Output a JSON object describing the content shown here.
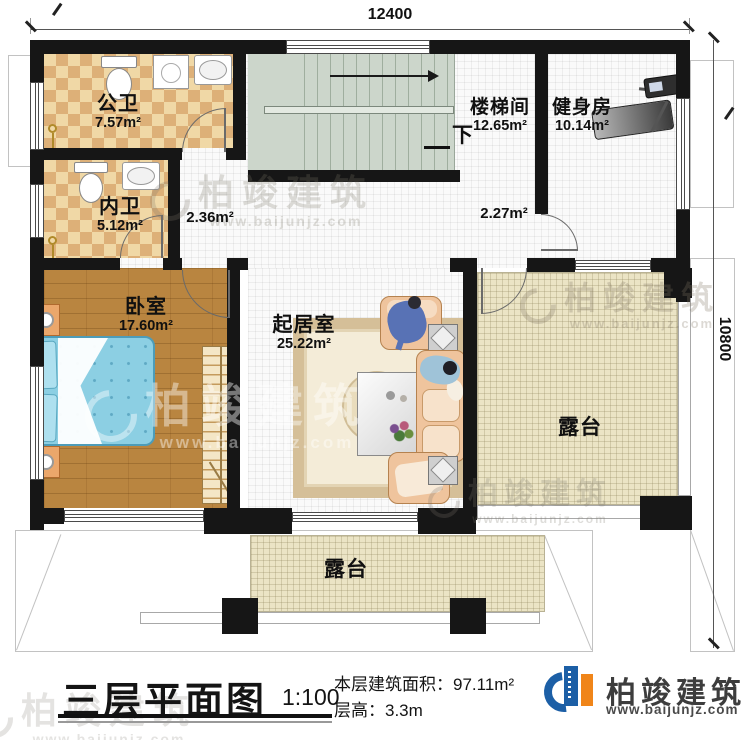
{
  "dimensions": {
    "top": "12400",
    "right": "10800"
  },
  "rooms": {
    "public_bath": {
      "name": "公卫",
      "area": "7.57m²"
    },
    "ensuite_bath": {
      "name": "内卫",
      "area": "5.12m²"
    },
    "bedroom": {
      "name": "卧室",
      "area": "17.60m²"
    },
    "stairwell": {
      "name": "楼梯间",
      "area": "12.65m²"
    },
    "gym": {
      "name": "健身房",
      "area": "10.14m²"
    },
    "living_room": {
      "name": "起居室",
      "area": "25.22m²"
    },
    "terrace_right": {
      "name": "露台"
    },
    "terrace_bottom": {
      "name": "露台"
    },
    "hall_left": {
      "area": "2.36m²"
    },
    "hall_right": {
      "area": "2.27m²"
    },
    "stairs_down_label": "下"
  },
  "footer": {
    "title": "三层平面图",
    "scale": "1:100",
    "floor_area_label": "本层建筑面积：",
    "floor_area_value": "97.11m²",
    "floor_height_label": "层高：",
    "floor_height_value": "3.3m"
  },
  "brand": {
    "name": "柏竣建筑",
    "website": "www.baijunjz.com"
  },
  "watermark": {
    "name": "柏竣建筑",
    "website": "www.baijunjz.com"
  },
  "colors": {
    "wall": "#161616",
    "bath_tile": "#f0d8a6",
    "bath_tile_dark": "#ddb078",
    "wood_floor": "#b98540",
    "bed_blue": "#8ccfe3",
    "stair_green": "#ccd6cb",
    "terrace_beige": "#ebe4c5",
    "sofa_salmon": "#efc49d",
    "logo_blue": "#1c5fa6",
    "logo_orange": "#f08519"
  }
}
